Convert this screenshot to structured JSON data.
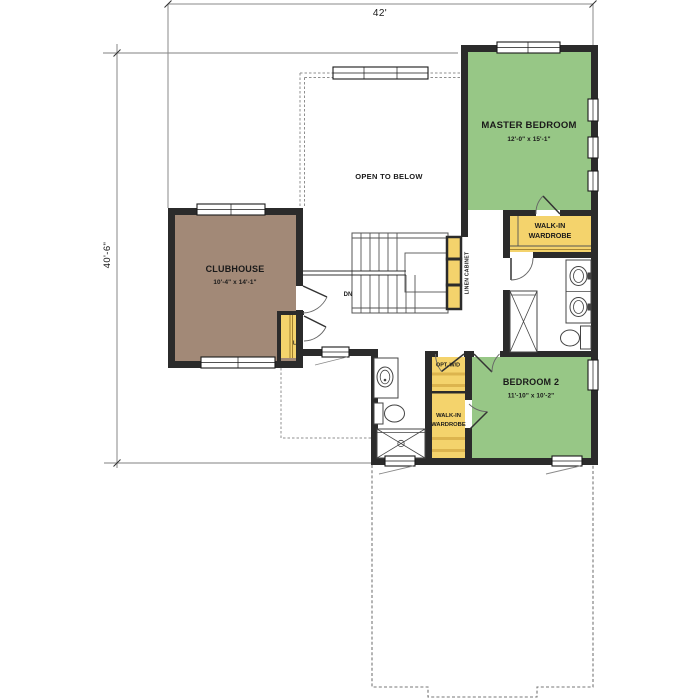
{
  "plan": {
    "dimensions": {
      "width": "42'",
      "height": "40'-6\""
    },
    "labels": {
      "open_to_below": "OPEN TO BELOW",
      "down": "DN",
      "linen_closet": "L",
      "linen_cabinet": "LINEN CABINET",
      "opt_wd": "OPT. W/D"
    },
    "rooms": {
      "master_bedroom": {
        "name": "MASTER BEDROOM",
        "size": "12'-0\" x 15'-1\""
      },
      "bedroom_2": {
        "name": "BEDROOM 2",
        "size": "11'-10\" x 10'-2\""
      },
      "clubhouse": {
        "name": "CLUBHOUSE",
        "size": "10'-4\" x 14'-1\""
      },
      "master_wardrobe": {
        "line1": "WALK-IN",
        "line2": "WARDROBE"
      },
      "bedroom2_wardrobe": {
        "line1": "WALK-IN",
        "line2": "WARDROBE"
      }
    },
    "colors": {
      "bedroom_green": "#97c786",
      "clubhouse_brown": "#a28977",
      "cabinet_yellow": "#f4d36c",
      "wall_black": "#2b2b2b"
    }
  }
}
